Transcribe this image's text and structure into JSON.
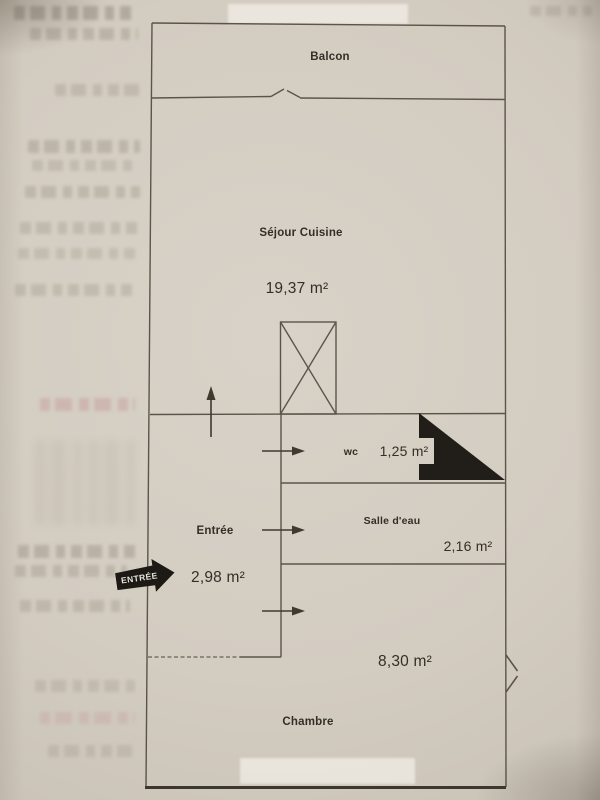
{
  "floorplan": {
    "rooms": [
      {
        "name": "Balcon",
        "area": ""
      },
      {
        "name": "Séjour Cuisine",
        "area": "19,37 m²"
      },
      {
        "name": "wc",
        "area": "1,25 m²"
      },
      {
        "name": "Entrée",
        "area": "2,98 m²"
      },
      {
        "name": "Salle d'eau",
        "area": "2,16 m²"
      },
      {
        "name": "Chambre",
        "area": "8,30 m²"
      }
    ],
    "entry_stamp_label": "ENTRÉE"
  },
  "colors": {
    "ink": "#4e483c",
    "paper": "#d2ccc1",
    "stamp_fill": "#1d1a16",
    "triangle_fill": "#211e19"
  }
}
